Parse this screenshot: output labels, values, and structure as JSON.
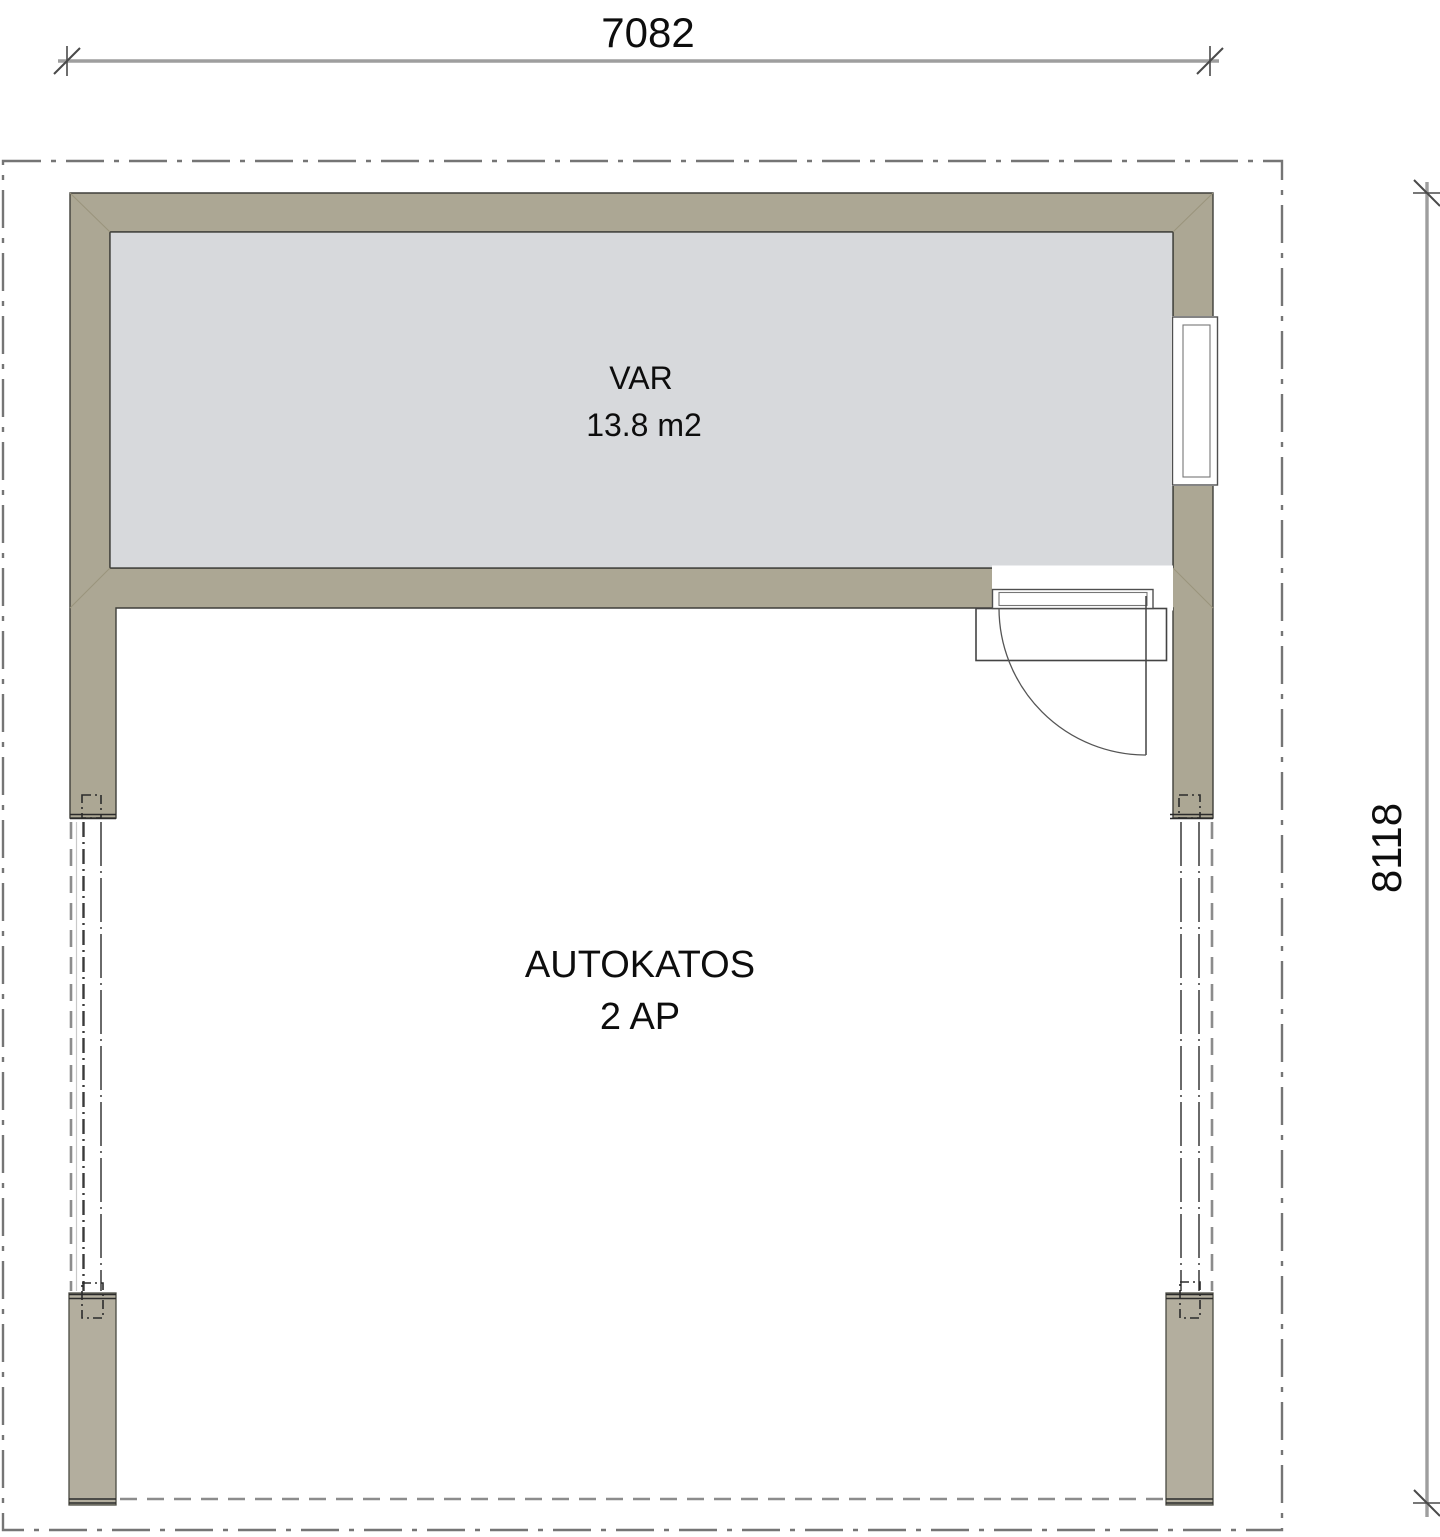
{
  "plan": {
    "storage_room": {
      "name": "VAR",
      "area": "13.8 m2"
    },
    "carport": {
      "name": "AUTOKATOS",
      "capacity": "2 AP"
    },
    "dimensions": {
      "width_mm": "7082",
      "depth_mm": "8118"
    }
  },
  "colors": {
    "wall": "#aca794",
    "column": "#b3ae9e",
    "room_floor": "#d7d9dc",
    "outline": "#3f3f3a",
    "roof_boundary": "#757575",
    "dimension_line": "#9e9e9e",
    "text": "#0d0d0d"
  }
}
